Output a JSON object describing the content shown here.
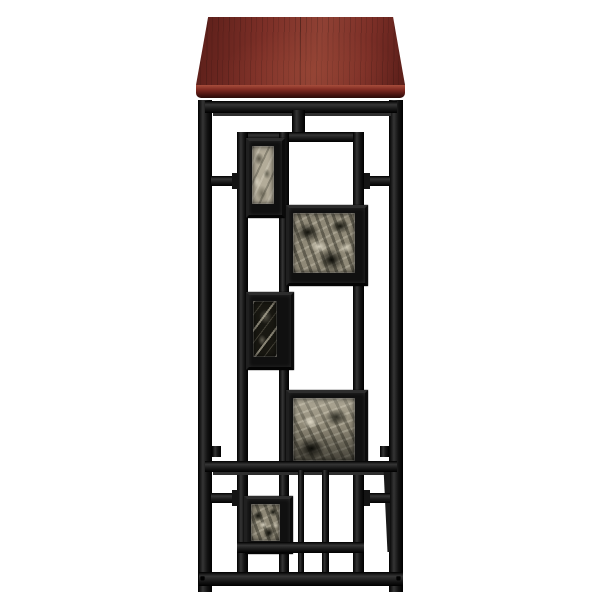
{
  "image": {
    "type": "product-photo",
    "subject": "Console side table with rectangular mahogany wood top and black metal geometric lattice frame inset with five faux-marble tiles",
    "orientation": "front view on white background"
  },
  "colors": {
    "bg": "#ffffff",
    "metal": "#141414",
    "metal-hi": "#353535",
    "metal-line": "#2e2e2e",
    "wood-base": "#7c2f27",
    "wood-dark": "#5a1e19",
    "wood-light": "#8f4134",
    "edge-hi": "#a84e3c",
    "edge-mid": "#7c2820",
    "edge-dark": "#40100d",
    "marble-light": "#b3ac99",
    "marble-mix": "#8f8977",
    "marble-dark": "#191812"
  },
  "parts": {
    "top": "mahogany finish wood top",
    "legs": "black square-tube legs",
    "apron": "front apron rail under top",
    "lattice": "geometric inner lattice panel",
    "tiles": [
      {
        "id": "tile-1",
        "position": "upper-left",
        "finish": "light gray marble"
      },
      {
        "id": "tile-2",
        "position": "upper-right square",
        "finish": "black-white marble"
      },
      {
        "id": "tile-3",
        "position": "middle-left",
        "finish": "dark marble with white veins"
      },
      {
        "id": "tile-4",
        "position": "lower-right square",
        "finish": "black-white marble"
      },
      {
        "id": "tile-5",
        "position": "bottom-left",
        "finish": "black-white marble"
      }
    ],
    "stretchers": "mid stretcher, slatted lower section and floor-level stretcher"
  }
}
